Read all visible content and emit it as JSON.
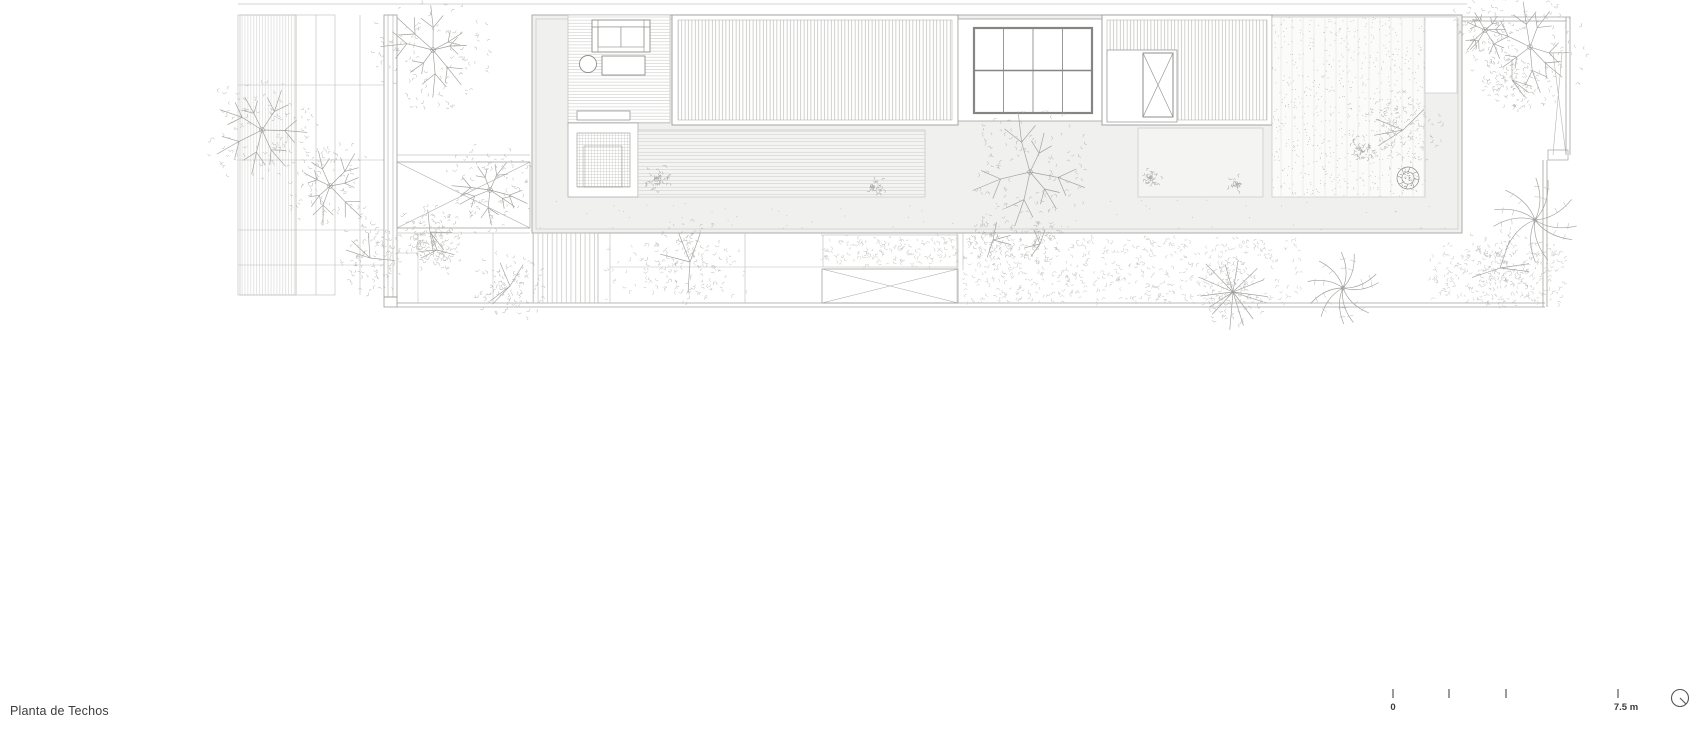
{
  "title": {
    "text": "Planta de Techos"
  },
  "scale_bar": {
    "zero_label": "0",
    "end_label": "7.5 m",
    "tick_x": [
      1393,
      1449,
      1506,
      1618
    ],
    "tick_y": 689,
    "tick_h": 9,
    "north_icon": {
      "cx": 1680,
      "cy": 698,
      "r": 8.5
    }
  },
  "colors": {
    "paper": "#ffffff",
    "deck_fill": "#f0f0ee",
    "planter_fill": "#f4f4f2",
    "courtyard_fill": "#fbfbfa",
    "line_light": "#c2c2c0",
    "line_mid": "#a3a3a1",
    "line_dark": "#7d7d7b",
    "branch": "#9f9f9d",
    "leaf": "#b5b5b3",
    "meadow": "#c4c4c2",
    "shrub": "#aeaeac",
    "dot": "#bdbdbb"
  },
  "drawing": {
    "trees": [
      {
        "t": "branch",
        "x": 262,
        "y": 130,
        "r": 55,
        "s": 11
      },
      {
        "t": "branch",
        "x": 330,
        "y": 186,
        "r": 46,
        "s": 22
      },
      {
        "t": "leafy",
        "x": 370,
        "y": 258,
        "r": 36,
        "s": 33
      },
      {
        "t": "branch",
        "x": 433,
        "y": 50,
        "r": 58,
        "s": 44
      },
      {
        "t": "branch",
        "x": 490,
        "y": 190,
        "r": 46,
        "s": 55
      },
      {
        "t": "leafy",
        "x": 430,
        "y": 232,
        "r": 32,
        "s": 66
      },
      {
        "t": "leafy",
        "x": 437,
        "y": 250,
        "r": 26,
        "s": 77
      },
      {
        "t": "leafy",
        "x": 510,
        "y": 286,
        "r": 36,
        "s": 88
      },
      {
        "t": "leafy",
        "x": 690,
        "y": 262,
        "r": 44,
        "s": 99
      },
      {
        "t": "branch",
        "x": 1030,
        "y": 172,
        "r": 62,
        "s": 110
      },
      {
        "t": "leafy",
        "x": 993,
        "y": 240,
        "r": 26,
        "s": 121
      },
      {
        "t": "leafy",
        "x": 1040,
        "y": 244,
        "r": 22,
        "s": 132
      },
      {
        "t": "leafy",
        "x": 1403,
        "y": 130,
        "r": 42,
        "s": 143
      },
      {
        "t": "branch",
        "x": 1530,
        "y": 47,
        "r": 60,
        "s": 154
      },
      {
        "t": "branch",
        "x": 1485,
        "y": 30,
        "r": 34,
        "s": 165
      },
      {
        "t": "leafy",
        "x": 1512,
        "y": 80,
        "r": 30,
        "s": 176
      },
      {
        "t": "palm",
        "x": 1535,
        "y": 220,
        "r": 42,
        "s": 187
      },
      {
        "t": "star",
        "x": 1233,
        "y": 292,
        "r": 40,
        "s": 198
      },
      {
        "t": "palm",
        "x": 1343,
        "y": 288,
        "r": 36,
        "s": 209
      },
      {
        "t": "leafy",
        "x": 1500,
        "y": 268,
        "r": 42,
        "s": 220
      }
    ],
    "plants": [
      {
        "t": "starplant",
        "x": 652,
        "y": 147,
        "r": 20,
        "s": 1
      },
      {
        "t": "leafclump",
        "x": 658,
        "y": 178,
        "r": 14,
        "s": 2
      },
      {
        "t": "starplant",
        "x": 682,
        "y": 162,
        "r": 11,
        "s": 3
      },
      {
        "t": "flower",
        "x": 698,
        "y": 183,
        "r": 11,
        "s": 4
      },
      {
        "t": "flower",
        "x": 837,
        "y": 182,
        "r": 11,
        "s": 5
      },
      {
        "t": "starplant",
        "x": 858,
        "y": 172,
        "r": 10,
        "s": 6
      },
      {
        "t": "starplant",
        "x": 878,
        "y": 158,
        "r": 11,
        "s": 7
      },
      {
        "t": "leafclump",
        "x": 875,
        "y": 186,
        "r": 9,
        "s": 8
      },
      {
        "t": "flower",
        "x": 903,
        "y": 178,
        "r": 13,
        "s": 9
      },
      {
        "t": "starplant",
        "x": 912,
        "y": 140,
        "r": 11,
        "s": 10
      },
      {
        "t": "starplant",
        "x": 1160,
        "y": 152,
        "r": 13,
        "s": 11
      },
      {
        "t": "leafclump",
        "x": 1150,
        "y": 178,
        "r": 12,
        "s": 12
      },
      {
        "t": "flower",
        "x": 1186,
        "y": 184,
        "r": 10,
        "s": 13
      },
      {
        "t": "starplant",
        "x": 1218,
        "y": 178,
        "r": 9,
        "s": 14
      },
      {
        "t": "leafclump",
        "x": 1236,
        "y": 184,
        "r": 8,
        "s": 15
      },
      {
        "t": "starplant",
        "x": 1378,
        "y": 180,
        "r": 16,
        "s": 16
      },
      {
        "t": "flowerdark",
        "x": 1408,
        "y": 178,
        "r": 11,
        "s": 17
      },
      {
        "t": "leafclump",
        "x": 1360,
        "y": 148,
        "r": 12,
        "s": 18
      }
    ],
    "meadows": [
      {
        "x": 963,
        "y": 238,
        "w": 337,
        "h": 64,
        "d": 40,
        "s": 7
      },
      {
        "x": 823,
        "y": 236,
        "w": 135,
        "h": 30,
        "d": 26,
        "s": 8
      },
      {
        "x": 1430,
        "y": 245,
        "w": 135,
        "h": 58,
        "d": 34,
        "s": 9
      },
      {
        "x": 600,
        "y": 236,
        "w": 150,
        "h": 64,
        "d": 140,
        "s": 10
      }
    ],
    "stipple_areas": [
      {
        "x": 1272,
        "y": 17,
        "w": 153,
        "h": 180,
        "d": 40,
        "s": 5
      },
      {
        "x": 536,
        "y": 200,
        "w": 920,
        "h": 30,
        "d": 420,
        "s": 6
      }
    ]
  }
}
